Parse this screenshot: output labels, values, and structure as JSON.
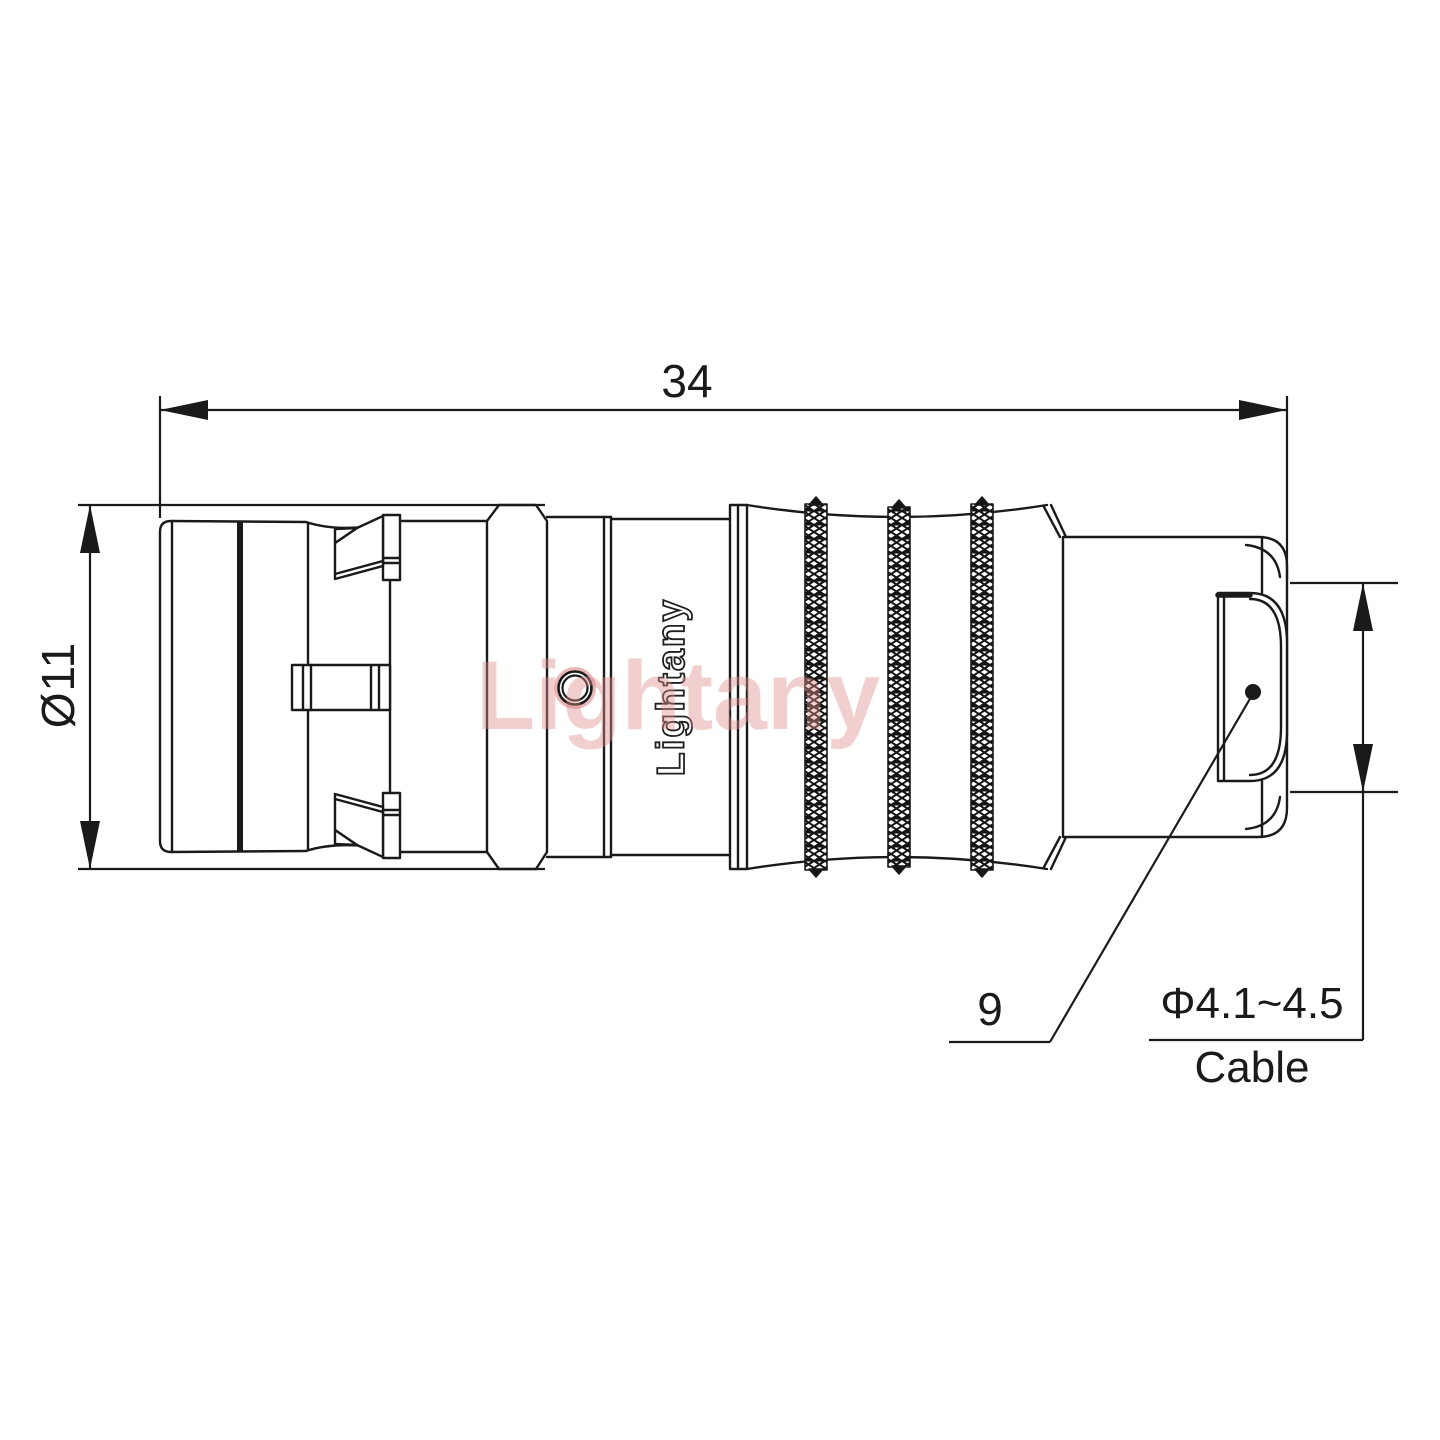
{
  "drawing": {
    "type": "engineering-connector-side-view",
    "dimensions": {
      "overall_length": "34",
      "body_diameter": "Ø11",
      "rear_section": "9",
      "cable_diameter_range": "Φ4.1~4.5",
      "cable_word": "Cable"
    },
    "branding": {
      "logo_on_body": "Lightany",
      "watermark": "Lightany"
    },
    "colors": {
      "line": "#1a1a1a",
      "background": "#ffffff",
      "watermark_pink": "#e28f8f",
      "hole_highlight_red": "#d97b7b"
    }
  }
}
